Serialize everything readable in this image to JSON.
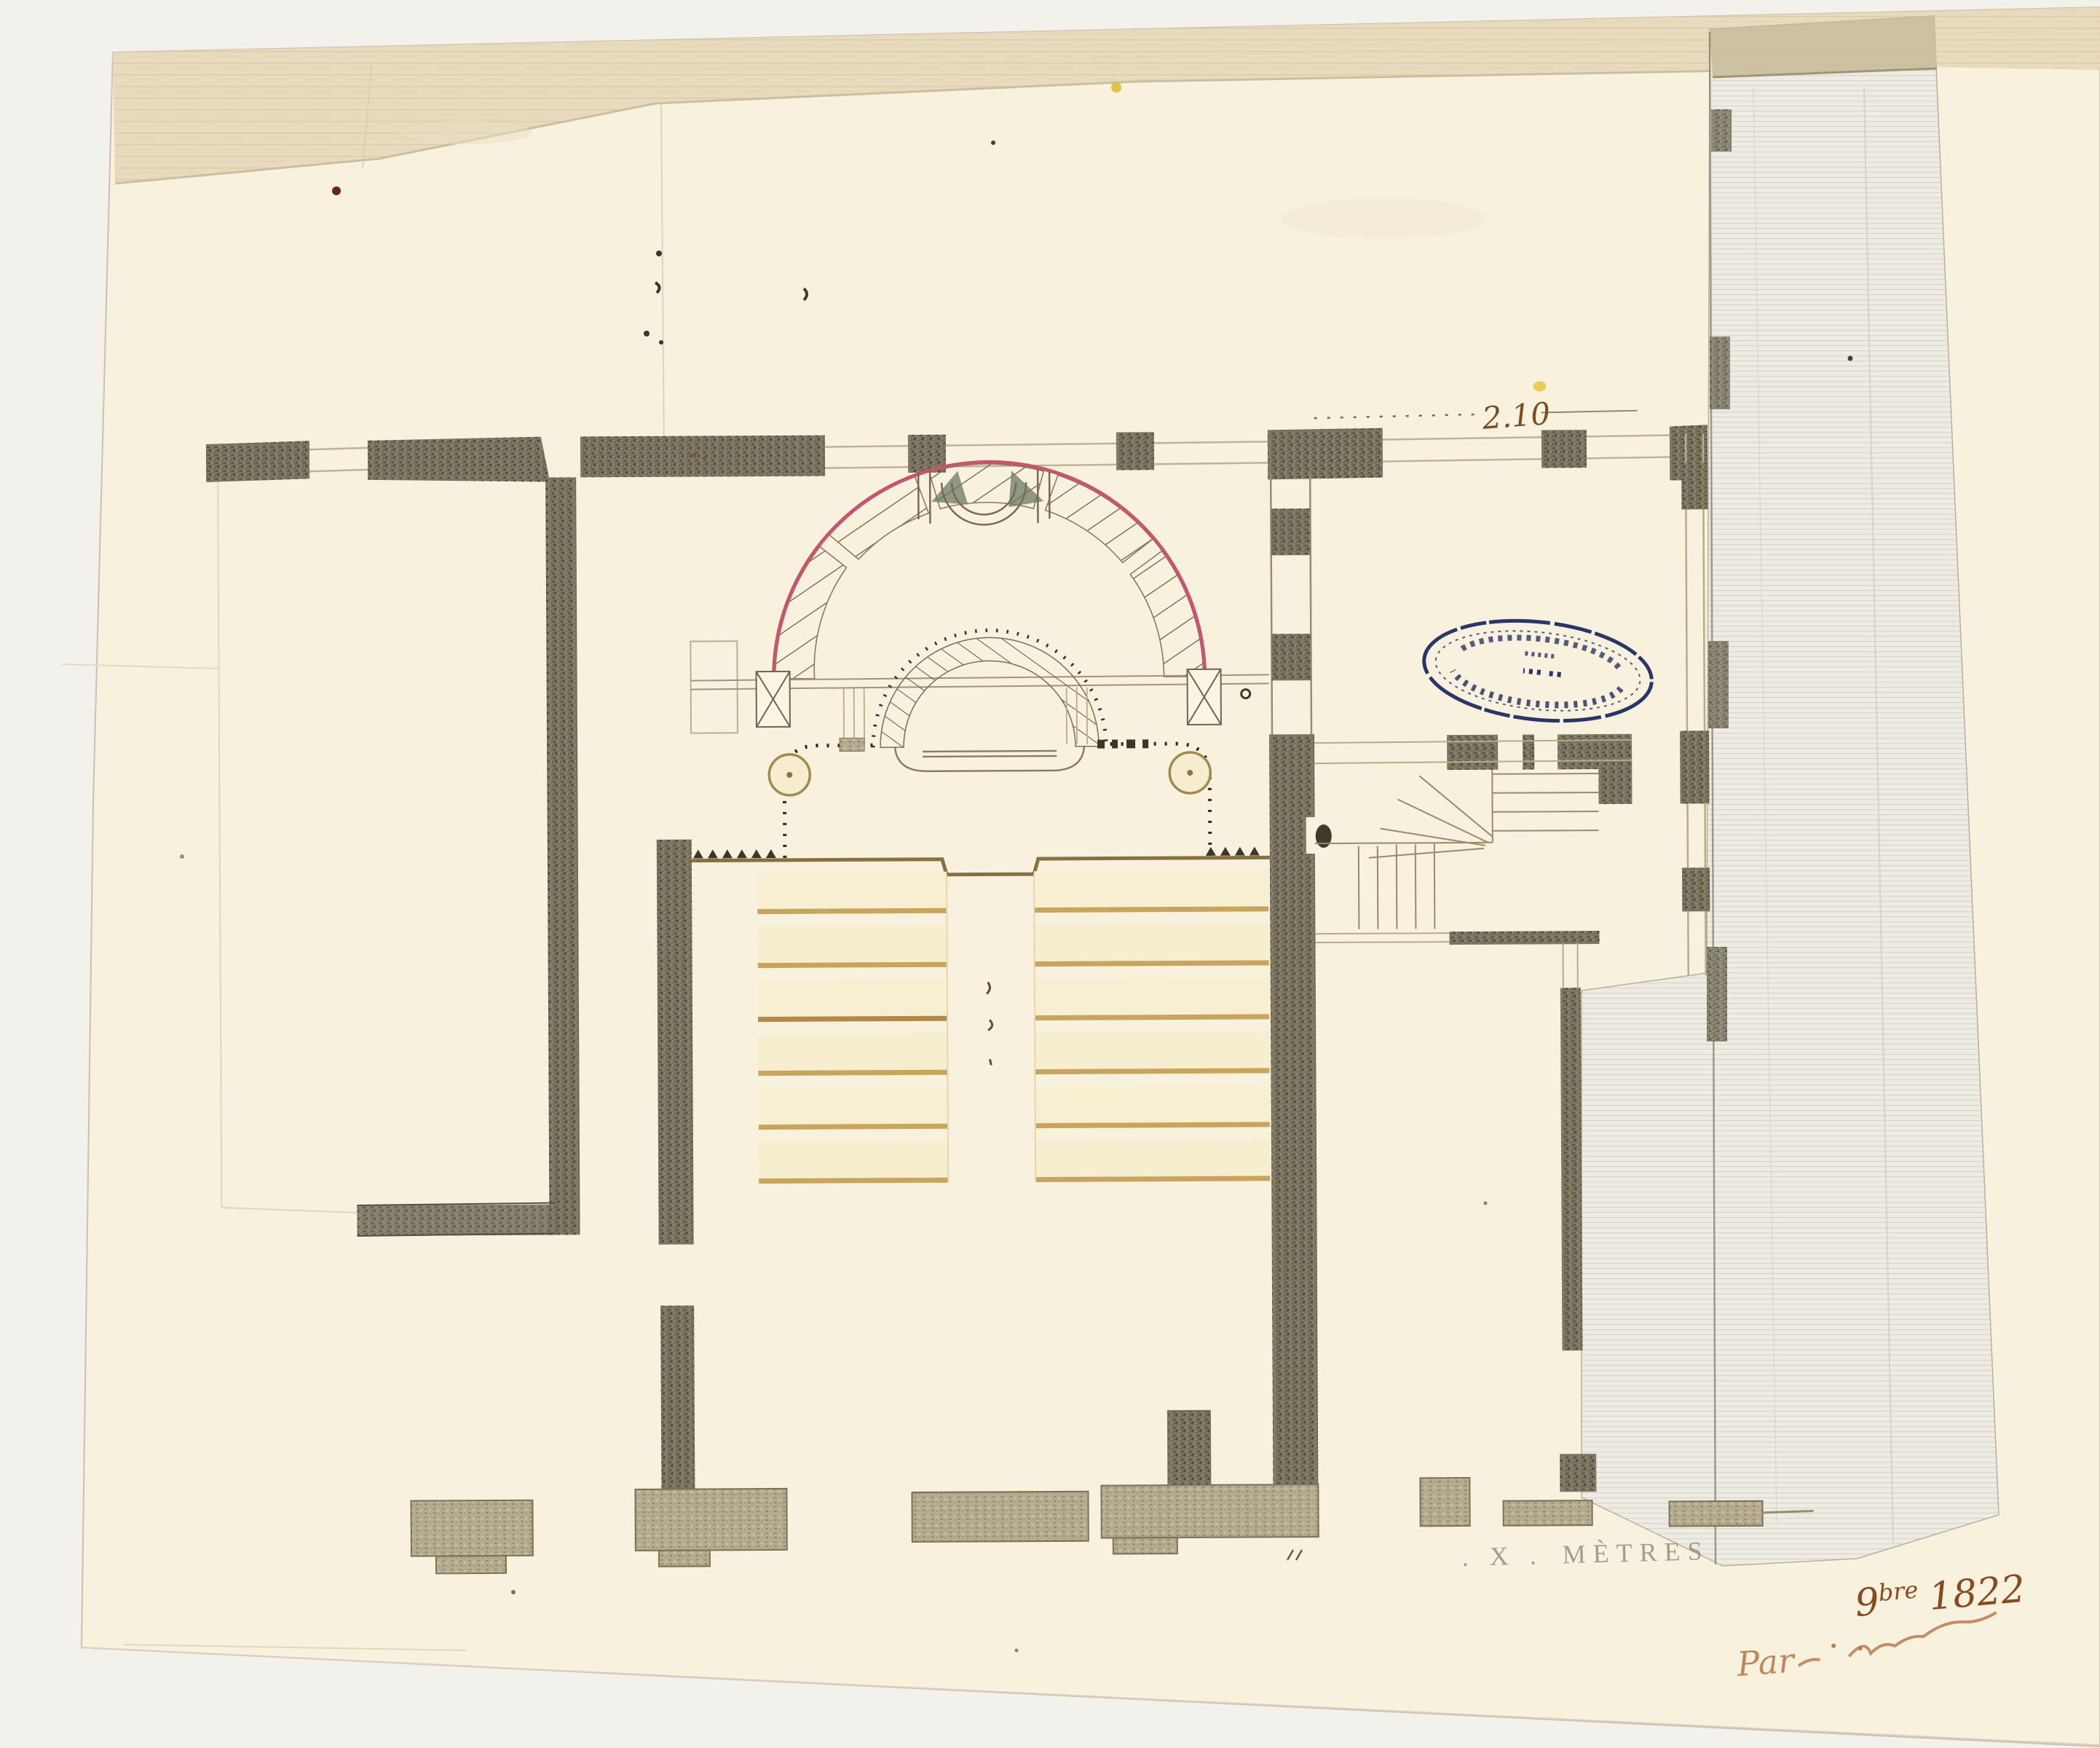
{
  "document": {
    "kind": "hand-drawn architectural floor plan photograph",
    "subject": "amphitheatre / lecture hall plan with semicircular hemicycle, bench rows, staircase and side rooms",
    "media": "ink and wash on cream paper"
  },
  "annotations": {
    "dimension_top_right": "2.10",
    "scale_mark": ". X .",
    "scale_unit": "MÈTRES",
    "date_day": "9",
    "date_superscript": "bre",
    "date_year": "1822",
    "inscription_prefix": "Par",
    "inscription_rest_legibility": "illegible flourish"
  },
  "stamp": {
    "shape": "oval",
    "rings": 2,
    "ink_color": "#2b3668",
    "orientation": "upside-down",
    "text_legibility": "illegible"
  },
  "plan_facts": {
    "bench_rows": 6,
    "bench_blocks": 2,
    "central_aisle": true,
    "columns_on_podium": 2,
    "hemicycle_rings": 2,
    "stair_type": "quarter-turn with winders",
    "footing_blocks_along_bottom": 7
  },
  "colors": {
    "paper": "#f8f1de",
    "backdrop": "#f3f1ec",
    "top_flap": "#e7d9ba",
    "wall_dark": "#736d58",
    "wall_light": "#b2a88c",
    "bench_fill": "#f8efd2",
    "bench_edge": "#c49a52",
    "hemicycle_pink": "#c4566e",
    "ink_sepia": "#8a4a1e",
    "stamp_blue": "#2b3668",
    "scale_text": "#8f897a"
  }
}
